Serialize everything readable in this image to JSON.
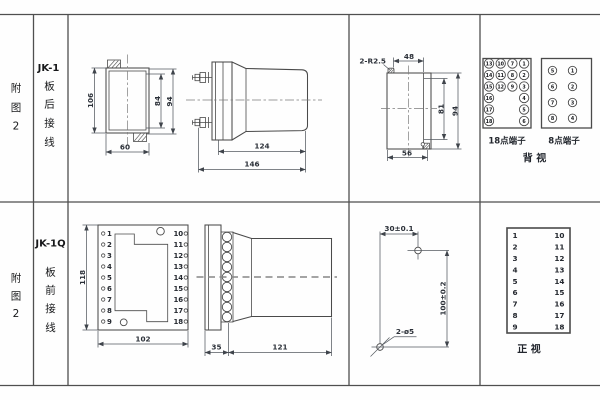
{
  "r1": {
    "fig": [
      "附",
      "图",
      "2"
    ],
    "model": "JK-1",
    "wiring": [
      "板",
      "后",
      "接",
      "线"
    ],
    "fv": {
      "h_outer": "106",
      "h_inner": "84",
      "h_case": "94",
      "w": "60"
    },
    "sv": {
      "d_case": "124",
      "d_total": "146"
    },
    "cut": {
      "note": "2-R2.5",
      "top": "48",
      "h_in": "81",
      "h_out": "94",
      "bot": "56"
    },
    "t18": {
      "label": "18点端子",
      "r0": [
        "13",
        "10",
        "7",
        "1"
      ],
      "r1": [
        "14",
        "11",
        "8",
        "2"
      ],
      "r2": [
        "15",
        "12",
        "9",
        "3"
      ],
      "r3": [
        "16",
        "4"
      ],
      "r4": [
        "17",
        "5"
      ],
      "r5": [
        "18",
        "6"
      ]
    },
    "t8": {
      "label": "8点端子",
      "r0": [
        "5",
        "1"
      ],
      "r1": [
        "6",
        "2"
      ],
      "r2": [
        "7",
        "3"
      ],
      "r3": [
        "8",
        "4"
      ]
    },
    "view": "背  视"
  },
  "r2": {
    "fig": [
      "附",
      "图",
      "2"
    ],
    "model": "JK-1Q",
    "wiring": [
      "板",
      "前",
      "接",
      "线"
    ],
    "fv": {
      "h": "118",
      "w": "102",
      "left": [
        "1",
        "2",
        "3",
        "4",
        "5",
        "6",
        "7",
        "8",
        "9"
      ],
      "right": [
        "10",
        "11",
        "12",
        "13",
        "14",
        "15",
        "16",
        "17",
        "18"
      ]
    },
    "sv": {
      "plate": "35",
      "body": "121"
    },
    "drill": {
      "dx": "30±0.1",
      "dy": "100±0.2",
      "note": "2-ø5"
    },
    "tbl": {
      "left": [
        "1",
        "2",
        "3",
        "4",
        "5",
        "6",
        "7",
        "8",
        "9"
      ],
      "right": [
        "10",
        "11",
        "12",
        "13",
        "14",
        "15",
        "16",
        "17",
        "18"
      ],
      "view": "正  视"
    }
  }
}
